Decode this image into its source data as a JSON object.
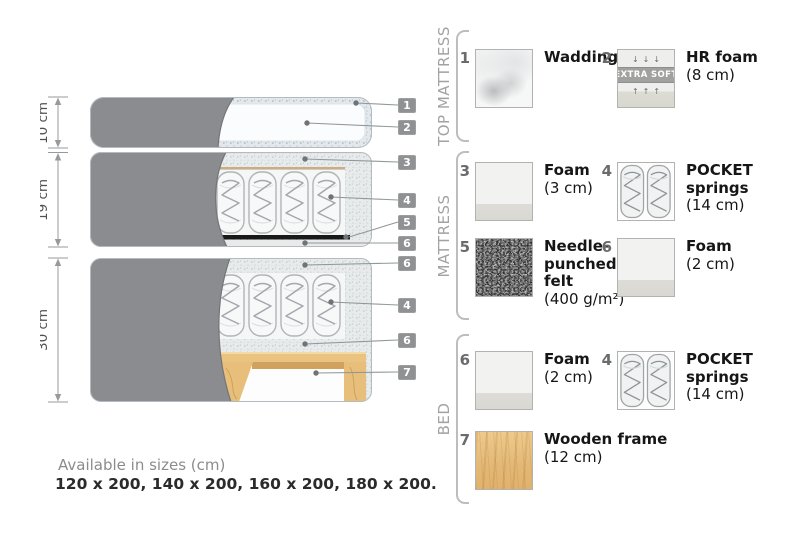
{
  "diagram": {
    "size_labels": [
      "10 cm",
      "19 cm",
      "30 cm"
    ],
    "tags": [
      "1",
      "2",
      "3",
      "4",
      "5",
      "6",
      "6",
      "4",
      "6",
      "7"
    ]
  },
  "legend": {
    "sections": [
      {
        "title": "TOP MATTRESS",
        "items": [
          {
            "num": "1",
            "name": "Wadding",
            "size": "",
            "swatch": "wadding"
          },
          {
            "num": "2",
            "name": "HR foam",
            "size": "(8 cm)",
            "swatch": "hrfoam",
            "badge": "EXTRA SOFT",
            "arrows_down": "↓↓↓",
            "arrows_up": "↑↑↑"
          }
        ]
      },
      {
        "title": "MATTRESS",
        "items": [
          {
            "num": "3",
            "name": "Foam",
            "size": "(3 cm)",
            "swatch": "foam"
          },
          {
            "num": "4",
            "name": "POCKET springs",
            "size": "(14 cm)",
            "swatch": "springs"
          },
          {
            "num": "5",
            "name": "Needle-punched felt",
            "size": "(400 g/m²)",
            "swatch": "felt"
          },
          {
            "num": "6",
            "name": "Foam",
            "size": "(2 cm)",
            "swatch": "foam"
          }
        ]
      },
      {
        "title": "BED",
        "items": [
          {
            "num": "6",
            "name": "Foam",
            "size": "(2 cm)",
            "swatch": "foam"
          },
          {
            "num": "4",
            "name": "POCKET springs",
            "size": "(14 cm)",
            "swatch": "springs"
          },
          {
            "num": "7",
            "name": "Wooden frame",
            "size": "(12 cm)",
            "swatch": "wood"
          }
        ]
      }
    ]
  },
  "footer": {
    "line1": "Available in sizes (cm)",
    "line2": "120 x 200, 140 x 200, 160 x 200, 180 x 200."
  },
  "colors": {
    "fabric_gray": "#8b8c90",
    "speckle_foam": "#e8ebec",
    "wood": "#e7bf7a",
    "felt_dark": "#5a5a5a",
    "tag_background": "#8f9193",
    "muted_text": "#a0a2a4",
    "dark_text": "#2b2b2b"
  }
}
